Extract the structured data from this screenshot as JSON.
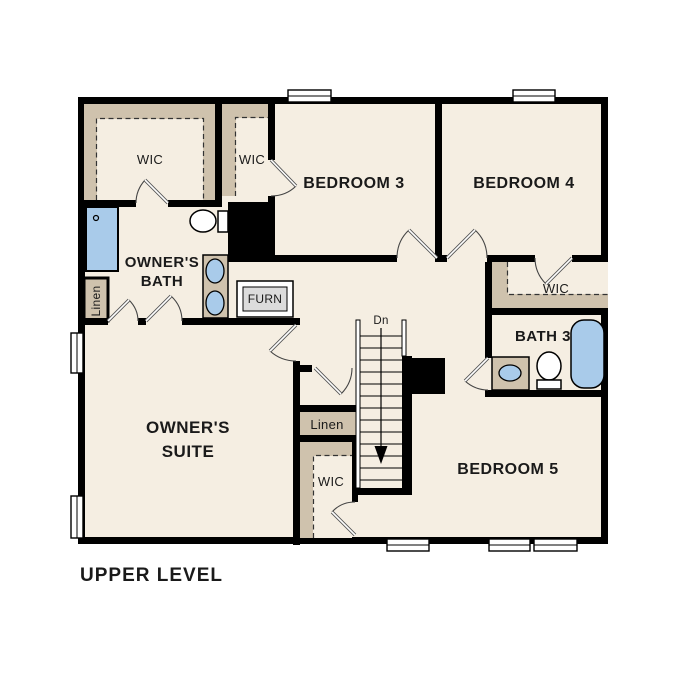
{
  "title": "UPPER LEVEL",
  "colors": {
    "floor": "#f5eee2",
    "shelf": "#cfc2ad",
    "fixture": "#a9cbea",
    "wall": "#000000",
    "furnace_fill": "#dcdcdc"
  },
  "rooms": {
    "owners_wic": "WIC",
    "bedroom3_wic": "WIC",
    "bedroom3": "BEDROOM 3",
    "bedroom4": "BEDROOM 4",
    "owners_bath_line1": "OWNER'S",
    "owners_bath_line2": "BATH",
    "linen_left": "Linen",
    "furnace": "FURN",
    "owners_suite_line1": "OWNER'S",
    "owners_suite_line2": "SUITE",
    "bedroom4_wic": "WIC",
    "bath3": "BATH 3",
    "stairs_direction": "Dn",
    "linen_hall": "Linen",
    "bedroom5_wic": "WIC",
    "bedroom5": "BEDROOM 5"
  }
}
